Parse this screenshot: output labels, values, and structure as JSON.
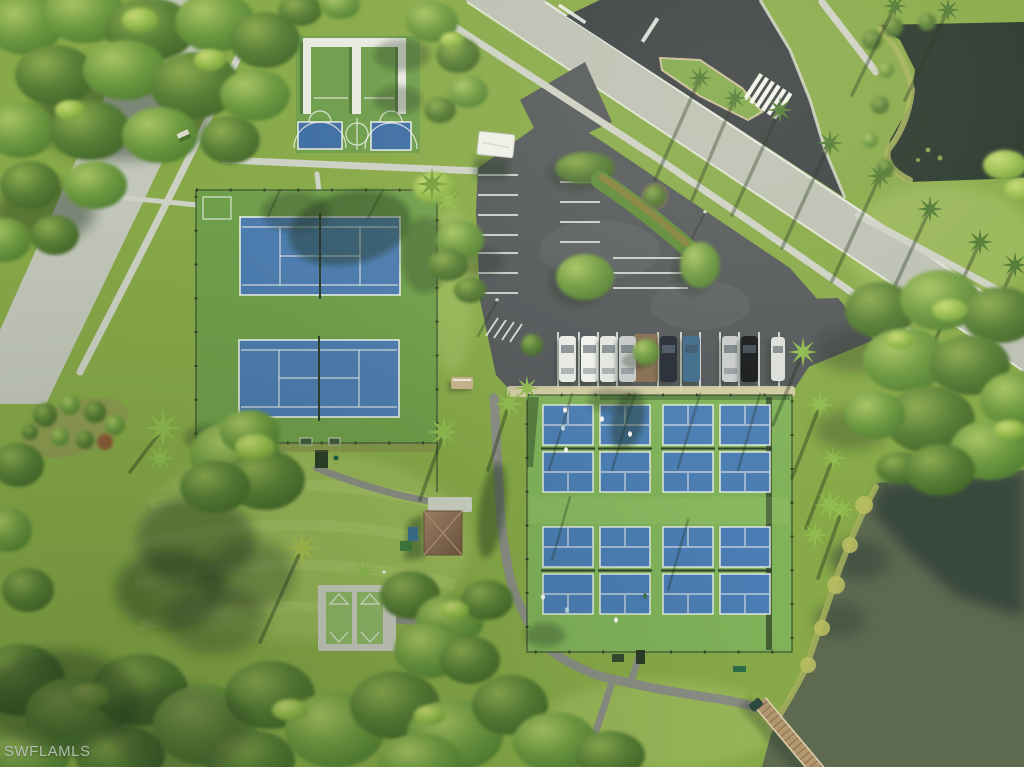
{
  "watermark": {
    "text": "SWFLAMLS"
  },
  "scene": {
    "type": "aerial-drone-photo",
    "subject": "Community recreation complex: tennis courts, pickleball courts, basketball half-courts, shuffleboard, parking lot, ponds and lake",
    "facilities": {
      "tennis_courts": 2,
      "pickleball_courts": 8,
      "basketball_half_courts": 2,
      "shuffleboard_lanes": 2,
      "parked_cars": 9,
      "water_bodies": 2
    }
  },
  "parking": {
    "cars": [
      {
        "color": "#e9ebe7"
      },
      {
        "color": "#f1f2ee"
      },
      {
        "color": "#e4e6e2"
      },
      {
        "color": "#c6c9c9"
      },
      {
        "color": "#252b36"
      },
      {
        "color": "#3e6b8c"
      },
      {
        "color": "#c9cccb"
      },
      {
        "color": "#17191c"
      },
      {
        "color": "#dcdedb"
      }
    ]
  },
  "colors": {
    "grassBase": "#87a948",
    "grassBright": "#9cba57",
    "courtGreen": "#6f9f4b",
    "courtBlue": "#4c7cb0",
    "pickleGreen": "#80b25a",
    "pickleBlue": "#4b7db4",
    "lineWhite": "#f2f4ee",
    "concrete": "#bcc0b4",
    "sidewalk": "#cdd1c5",
    "asphaltDark": "#383e42",
    "asphaltLot": "#53575a",
    "waterDark": "#27352c",
    "waterOlive": "#5d6a50",
    "waterShadow": "#39473d",
    "treeLight": "#a6c15f",
    "treeMid": "#6e9a41",
    "treeDark": "#4f7a32",
    "roofBrown": "#8c6c52",
    "reed": "#a7b35c",
    "bridgeTan": "#b2976f",
    "sand": "#d8cfac"
  }
}
